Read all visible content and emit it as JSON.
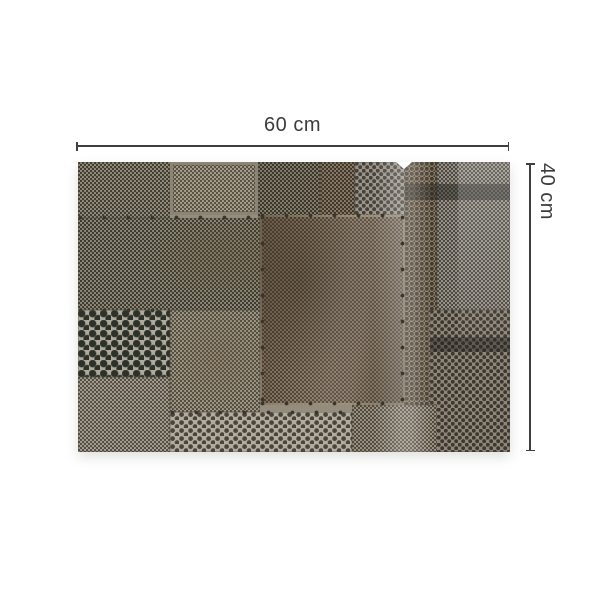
{
  "product": {
    "description": "patchwork collage of weathered perforated metal sheets",
    "width_label": "60 cm",
    "height_label": "40 cm"
  },
  "colors": {
    "background": "#ffffff",
    "dimension_line": "#3f3f3f",
    "dimension_text": "#3c3c3c",
    "metal_base": "#948d7d",
    "metal_dark_hole": "#2c322a",
    "metal_rust": "#897963"
  }
}
